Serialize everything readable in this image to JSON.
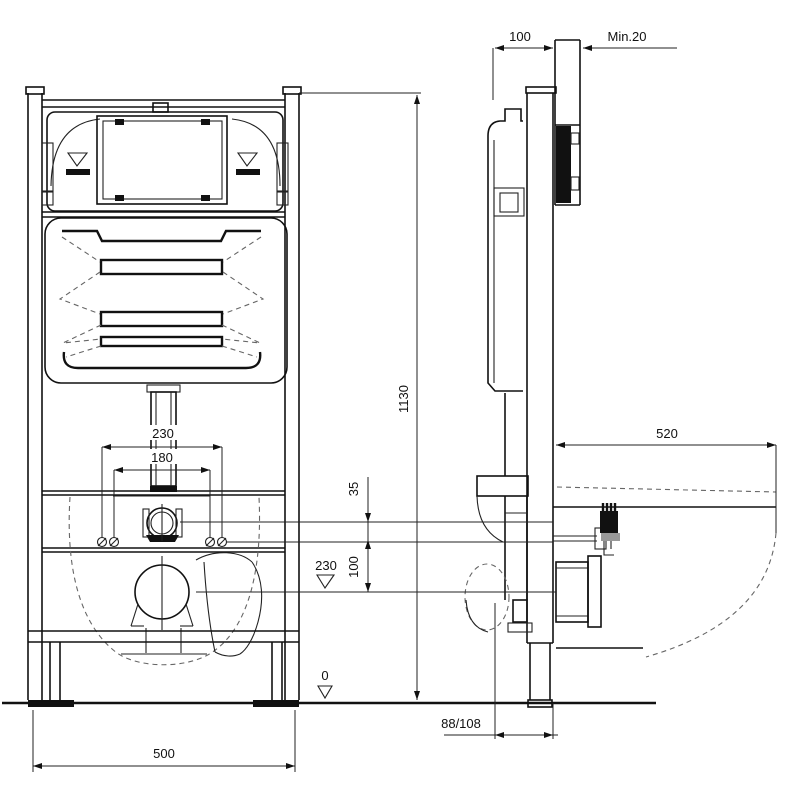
{
  "front_view": {
    "dimensions": {
      "flush_pipe_spacing": "230",
      "fixing_bolt_spacing": "180",
      "flush_to_bolts": "35",
      "bolts_to_outlet": "100",
      "outlet_height": "230",
      "frame_height": "1130",
      "floor_level": "0",
      "frame_width": "500"
    }
  },
  "side_view": {
    "dimensions": {
      "frame_depth": "100",
      "min_wall_clearance": "Min.20",
      "install_depth": "520",
      "outlet_pipe": "88/108"
    }
  },
  "colors": {
    "line": "#111111",
    "dimension": "#222222",
    "hidden_line": "#666666",
    "background": "#ffffff"
  }
}
